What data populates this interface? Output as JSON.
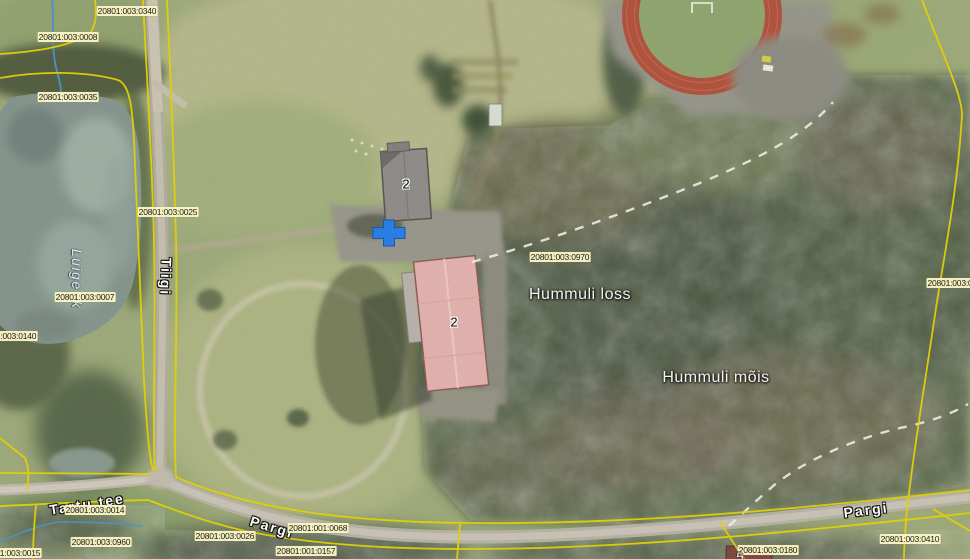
{
  "app": {
    "type": "cadastral-aerial-web-map"
  },
  "colors": {
    "boundary_yellow": "#e4d407",
    "cadastral_label_bg": "#fbf5c6",
    "marker_blue": "#2a7de1",
    "water_gray_green": "#87968e",
    "track_red": "#b2543e",
    "road_gray": "#b8b3a5"
  },
  "marker": {
    "x": 389,
    "y": 233
  },
  "labels": {
    "places": [
      {
        "text": "Hummuli loss",
        "x": 580,
        "y": 295,
        "size": 16
      },
      {
        "text": "Hummuli mõis",
        "x": 716,
        "y": 378,
        "size": 16
      }
    ],
    "water": [
      {
        "text": "Luige jk",
        "x": 77,
        "y": 279,
        "rot": 90,
        "size": 14
      }
    ],
    "roads": [
      {
        "text": "Tiigi",
        "x": 166,
        "y": 277,
        "rot": 92
      },
      {
        "text": "Tartu tee",
        "x": 87,
        "y": 504,
        "rot": -9
      },
      {
        "text": "Pargi",
        "x": 272,
        "y": 527,
        "rot": 17
      },
      {
        "text": "Pargi",
        "x": 866,
        "y": 510,
        "rot": -7
      }
    ],
    "cadastral": [
      {
        "text": "20801:003:0340",
        "x": 127,
        "y": 11
      },
      {
        "text": "20801:003:0008",
        "x": 68,
        "y": 37
      },
      {
        "text": "20801:003:0035",
        "x": 68,
        "y": 97
      },
      {
        "text": "20801:003:0025",
        "x": 168,
        "y": 212
      },
      {
        "text": "20801:003:0007",
        "x": 85,
        "y": 297
      },
      {
        "text": "20801:003:0140",
        "x": 7,
        "y": 336
      },
      {
        "text": "20801:003:0970",
        "x": 560,
        "y": 257
      },
      {
        "text": "20801:003:0",
        "x": 950,
        "y": 283
      },
      {
        "text": "20801:003:0014",
        "x": 95,
        "y": 510
      },
      {
        "text": "20801:003:0960",
        "x": 101,
        "y": 542
      },
      {
        "text": "20801:003:0026",
        "x": 225,
        "y": 536
      },
      {
        "text": "20801:003:0015",
        "x": 11,
        "y": 553
      },
      {
        "text": "20801:001:0068",
        "x": 318,
        "y": 528
      },
      {
        "text": "20801:001:0157",
        "x": 306,
        "y": 551
      },
      {
        "text": "20801:003:0180",
        "x": 768,
        "y": 550
      },
      {
        "text": "20801:003:0410",
        "x": 910,
        "y": 539
      }
    ],
    "building_numbers": [
      {
        "text": "2",
        "x": 406,
        "y": 184
      },
      {
        "text": "2",
        "x": 454,
        "y": 322
      },
      {
        "text": "5",
        "x": 740,
        "y": 557,
        "light": true
      }
    ]
  }
}
